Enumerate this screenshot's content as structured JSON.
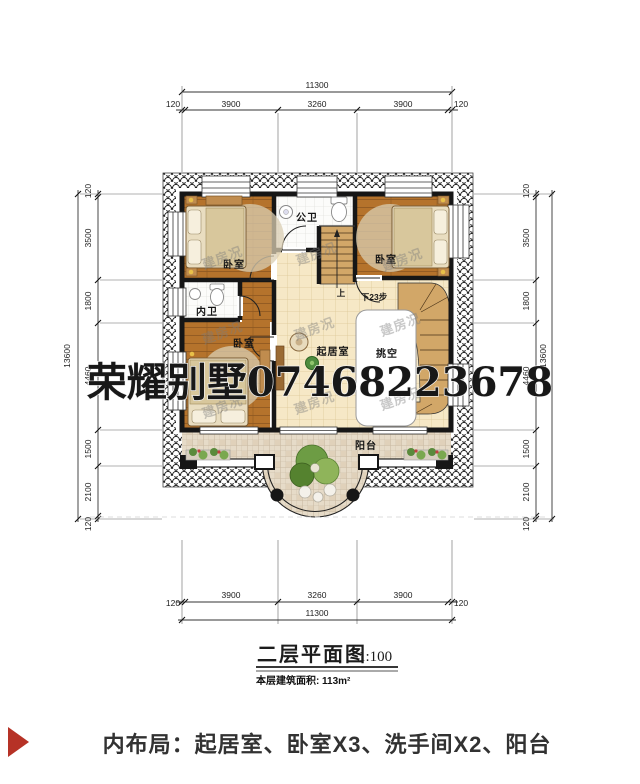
{
  "dims": {
    "top": {
      "total": "11300",
      "segments": [
        "120",
        "3900",
        "3260",
        "3900",
        "120"
      ]
    },
    "bottom": {
      "total": "11300",
      "segments": [
        "3900",
        "3260",
        "3900"
      ],
      "sides": [
        "120",
        "120"
      ]
    },
    "left": {
      "total": "13600",
      "segments": [
        "120",
        "3500",
        "1800",
        "4460",
        "1500",
        "2100",
        "120"
      ]
    },
    "right": {
      "total": "13600",
      "segments": [
        "120",
        "3500",
        "1800",
        "4460",
        "1500",
        "2100",
        "120"
      ]
    }
  },
  "rooms": {
    "bedroom": "卧室",
    "bath_public": "公卫",
    "bath_inner": "内卫",
    "living": "起居室",
    "void": "挑空",
    "balcony": "阳台"
  },
  "stairs": {
    "up": "上",
    "down": "下23步"
  },
  "watermark": {
    "brand": "荣耀别墅07468223678",
    "tile": "建房况"
  },
  "title": {
    "name": "二层平面图",
    "scale": "1:100",
    "area_label": "本层建筑面积:",
    "area_value": "113m²"
  },
  "footer": {
    "text": "内布局：起居室、卧室X3、洗手间X2、阳台"
  },
  "colors": {
    "accent_red": "#b63226",
    "wall": "#161616",
    "wood_floor": "#b5732c",
    "living_tile": "#f6e8c6",
    "bath_tile": "#fcfcfa",
    "balcony_tile": "#e6dbc8"
  }
}
